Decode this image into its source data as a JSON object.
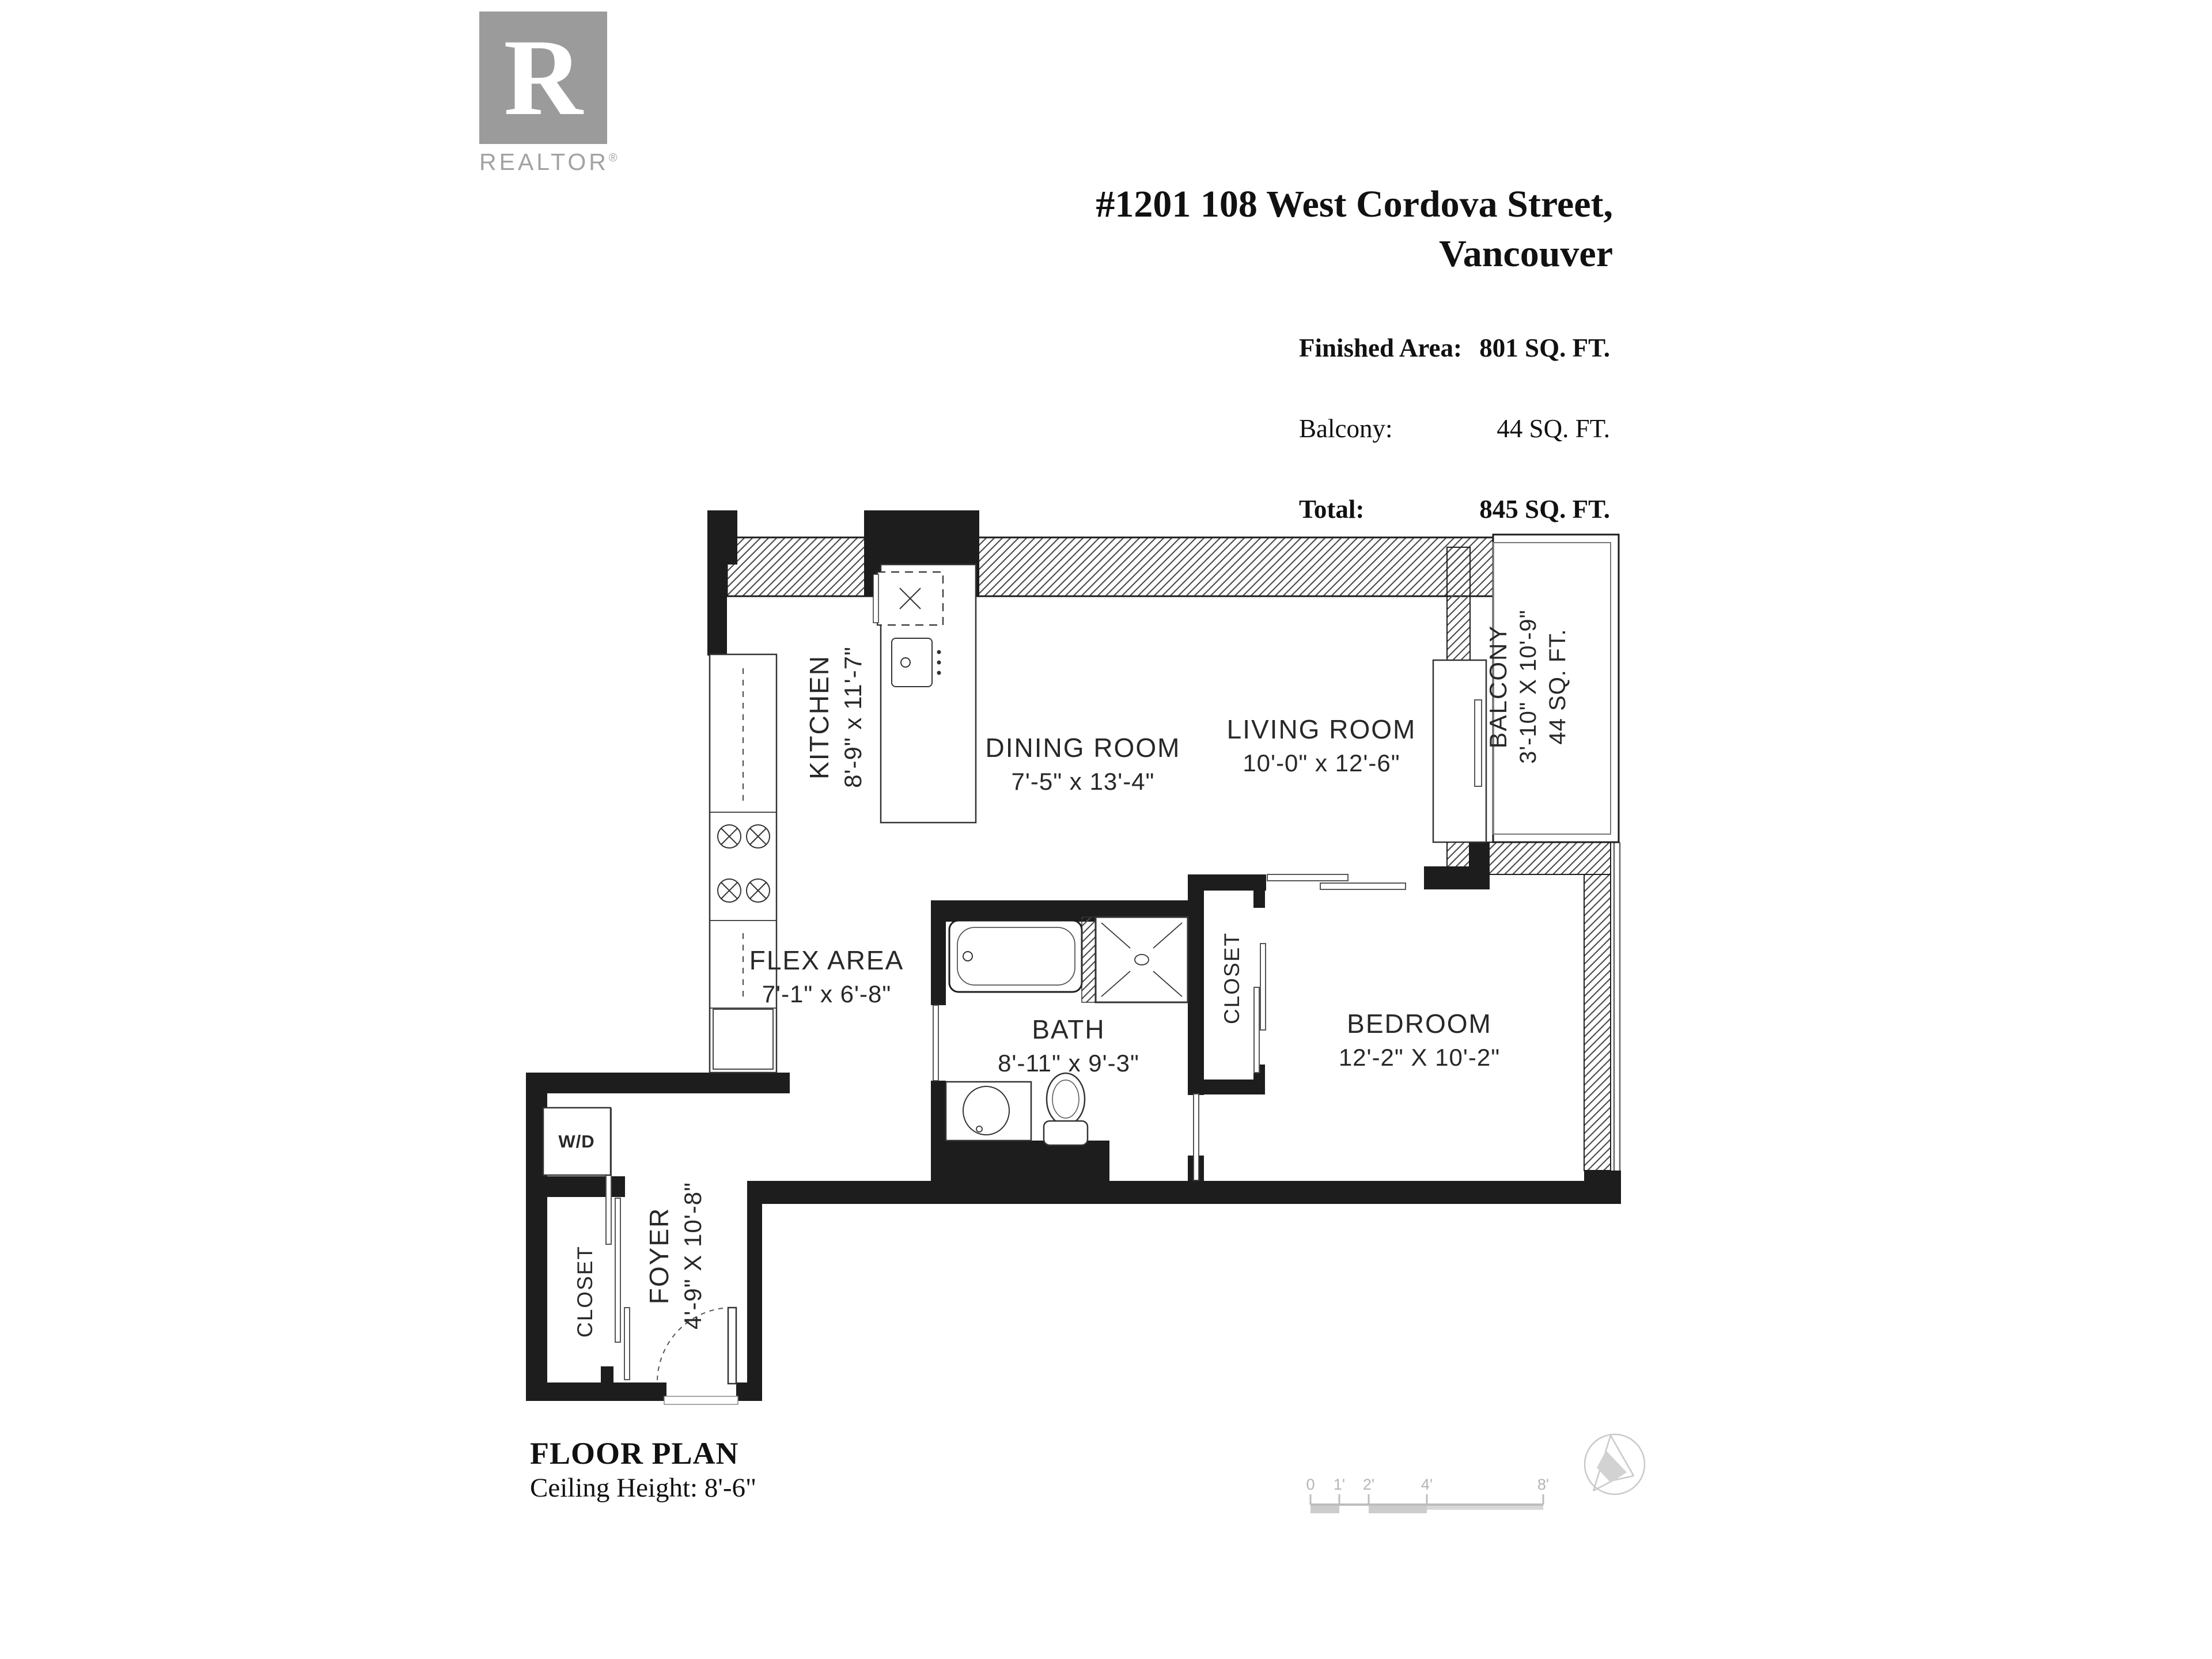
{
  "logo": {
    "r": "R",
    "wordmark": "REALTOR",
    "registered": "®"
  },
  "header": {
    "address_line1": "#1201 108 West Cordova Street,",
    "address_line2": "Vancouver"
  },
  "stats": {
    "rows": [
      {
        "label": "Finished Area:",
        "value": "801 SQ. FT."
      },
      {
        "label": "Balcony:",
        "value": "44 SQ. FT."
      },
      {
        "label": "Total:",
        "value": "845 SQ. FT."
      }
    ]
  },
  "rooms": {
    "kitchen": {
      "name": "KITCHEN",
      "dims": "8'-9\" x 11'-7\""
    },
    "dining_room": {
      "name": "DINING ROOM",
      "dims": "7'-5\" x 13'-4\""
    },
    "living_room": {
      "name": "LIVING ROOM",
      "dims": "10'-0\" x 12'-6\""
    },
    "balcony": {
      "name": "BALCONY",
      "dims": "3'-10\" X 10'-9\"",
      "area": "44 SQ. FT."
    },
    "flex_area": {
      "name": "FLEX AREA",
      "dims": "7'-1\" x 6'-8\""
    },
    "bath": {
      "name": "BATH",
      "dims": "8'-11\" x 9'-3\""
    },
    "bedroom": {
      "name": "BEDROOM",
      "dims": "12'-2\" X 10'-2\""
    },
    "bedroom_closet": {
      "name": "CLOSET"
    },
    "foyer_closet": {
      "name": "CLOSET"
    },
    "washer_dryer": {
      "name": "W/D"
    },
    "foyer": {
      "name": "FOYER",
      "dims": "4'-9\" X 10'-8\""
    }
  },
  "footer": {
    "title": "FLOOR PLAN",
    "ceiling": "Ceiling Height: 8'-6\"",
    "scale_ticks": [
      "0",
      "1'",
      "2'",
      "4'",
      "8'"
    ]
  },
  "colors": {
    "ink": "#1d1d1d",
    "logo_gray": "#9b9b9b",
    "faint_gray": "#c9c9c9"
  }
}
